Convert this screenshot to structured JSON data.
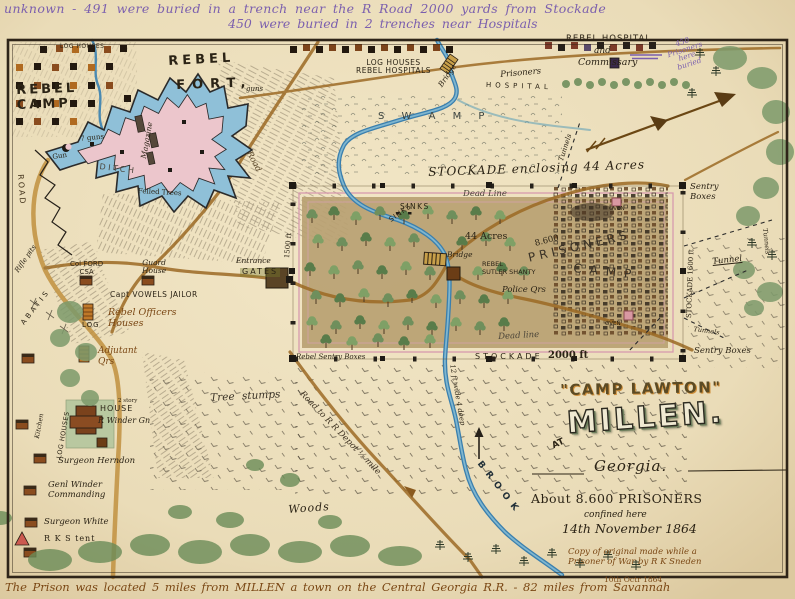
{
  "colors": {
    "paper": "#eadcb8",
    "ink": "#2b2315",
    "brown_ink": "#7a4714",
    "purple_ink": "#7b5fae",
    "water": "#3a7fae",
    "fort_pink": "#ecc6cc",
    "ditch_blue": "#8fc0d8",
    "deadline_pink": "#d69aae",
    "stockade_ground": "#b9a172",
    "tree_green": "#6f8f5c"
  },
  "notes": {
    "top1": "unknown - 491 were buried in a trench near the R Road 2000 yards from Stockade",
    "top2": "450 were buried in 2 trenches near Hospitals",
    "bottom": "The Prison was located 5 miles from MILLEN a town on the Central Georgia R.R. - 82 miles from Savannah",
    "date_note": "10th Octr 1864",
    "purple450": "450\nPrisoners\nhere\nburied"
  },
  "fort": {
    "log_houses": "LOG HOUSES",
    "rebel_camp": "REBEL\nCAMP",
    "rebel": "REBEL",
    "fort": "FORT,",
    "guns": "guns",
    "magazine": "Magazine",
    "seven_guns": "7 guns",
    "gun": "Gun",
    "ditch": "DITCH",
    "felled_trees": "Felled Trees",
    "road_left": "ROAD",
    "road_diag": "Road",
    "rifle_pits": "Rifle pits",
    "abatis": "ABATIS"
  },
  "north": {
    "log_hosp": "LOG HOUSES\nREBEL HOSPITALS",
    "bridge": "Bridge",
    "prisoners": "Prisoners",
    "hospital": "HOSPITAL",
    "rebel_hospital": "REBEL HOSPITAL",
    "and": "and",
    "commissary": "Commissary",
    "swamp": "S W A M P",
    "tunnels_ne": "Tunnels"
  },
  "stockade": {
    "title": "STOCKADE enclosing 44 Acres",
    "dead_top": "Dead Line",
    "dead_bottom": "Dead line",
    "sinks1": "SINKS",
    "sinks2": "SINKS",
    "acres": "44 Acres",
    "count": "8.600",
    "prisoners": "PRISONERS",
    "camp": "CAMP",
    "bridge": "Bridge",
    "sutler": "REBEL\nSUTLER SHANTY",
    "police": "Police Qrs",
    "oven1": "OVEN",
    "oven2": "OVEN",
    "west_len": "1500 ft",
    "east_len": "STOCKADE 1600 ft",
    "south_word": "STOCKADE",
    "south_len": "2000 ft",
    "entrance": "Entrance",
    "gates": "GATES",
    "rebel_sentry": "Rebel Sentry Boxes",
    "sentry_ne": "Sentry\nBoxes",
    "sentry_se": "Sentry Boxes",
    "tunnel_e": "Tunnel",
    "tunnels_se": "Tunnels",
    "tunnel_edge": "Tunnels"
  },
  "west": {
    "col_ford": "Col FORD\nCSA",
    "guard": "Guard\nHouse",
    "jailor": "Capt VOWELS JAILOR",
    "officers": "Rebel Officers\nHouses",
    "log": "LOG",
    "adjutant": "Adjutant\nQrs",
    "kitchen": "Kitchen",
    "log_houses": "LOG HOUSES",
    "story": "2 story",
    "house": "HOUSE",
    "winder": "R Winder Gn",
    "herndon": "Surgeon Herndon",
    "commanding": "Genl Winder\nCommanding",
    "white": "Surgeon White",
    "rks": "R K S tent"
  },
  "south": {
    "stumps": "Tree stumps",
    "rr": "Road to R R Depot ½ mile",
    "woods": "Woods",
    "brook": "BROOK",
    "stream": "12 ft wide 4 deep"
  },
  "title": {
    "lawton": "\"CAMP LAWTON\"",
    "at": "AT",
    "millen": "MILLEN.",
    "georgia": "Georgia.",
    "about": "About 8.600 PRISONERS",
    "confined": "confined here",
    "date": "14th November 1864",
    "credit1": "Copy of original made while a",
    "credit2": "Prisoner of War by R K Sneden"
  }
}
